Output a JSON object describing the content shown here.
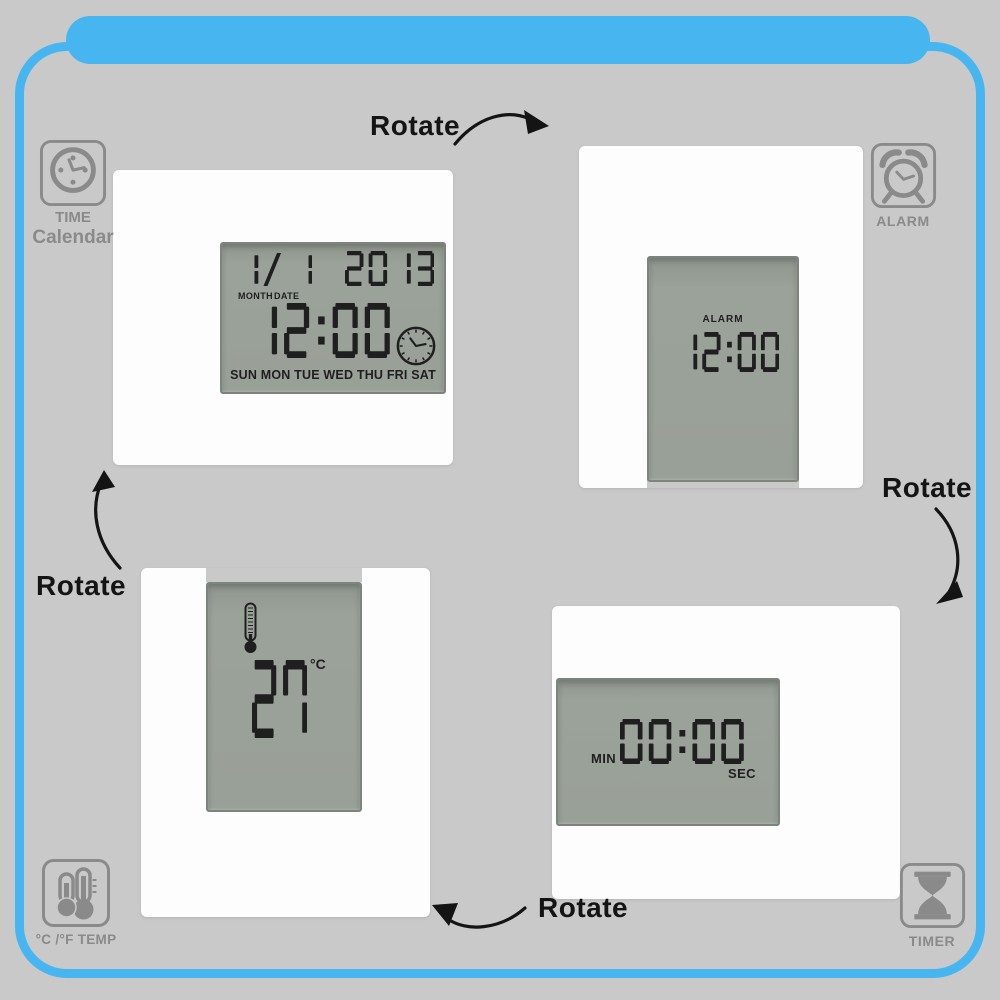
{
  "colors": {
    "background": "#c9c9c9",
    "accent_blue": "#47b6f0",
    "clock_body": "#fdfdfd",
    "lcd_panel": "#9aa199",
    "lcd_text": "#1f1f1f",
    "icon_gray": "#8a8a8a",
    "annotation_black": "#141414"
  },
  "rotate_labels": {
    "top": "Rotate",
    "right": "Rotate",
    "bottom": "Rotate",
    "left": "Rotate"
  },
  "mode_icons": {
    "time_calendar": {
      "label_line1": "TIME",
      "label_line2": "Calendar"
    },
    "alarm": {
      "label": "ALARM"
    },
    "temperature": {
      "label": "°C /°F TEMP"
    },
    "timer": {
      "label": "TIMER"
    }
  },
  "clocks": {
    "time_calendar": {
      "month_day": "1/ 1",
      "month_label": "MONTH",
      "date_label": "DATE",
      "year": "2013",
      "time": "12:00",
      "weekdays": "SUN MON TUE WED THU FRI SAT"
    },
    "alarm": {
      "mode_label": "ALARM",
      "time": "12:00"
    },
    "temperature": {
      "value": "27",
      "unit": "°C"
    },
    "timer": {
      "min_label": "MIN",
      "value": "00:00",
      "sec_label": "SEC"
    }
  }
}
